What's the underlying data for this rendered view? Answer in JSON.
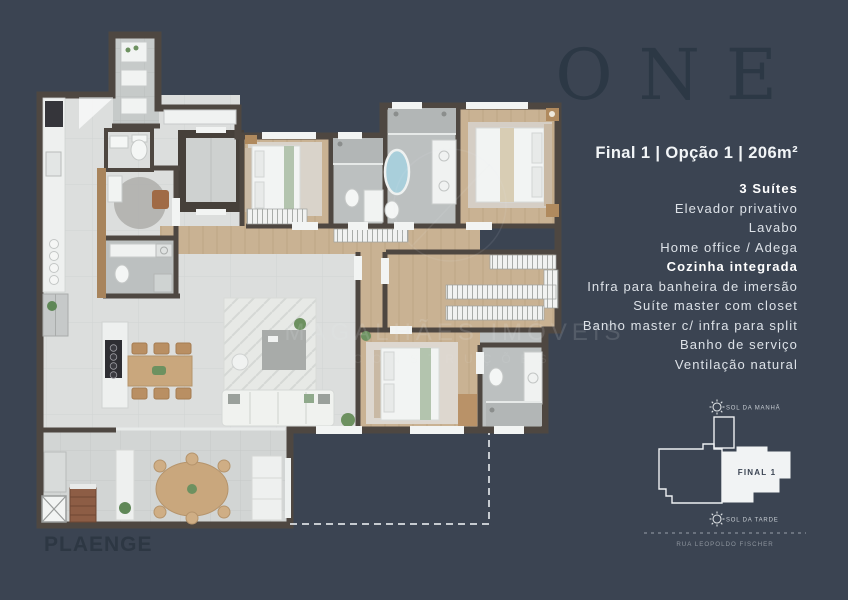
{
  "brand": {
    "development_logo": "ONE",
    "builder_logo": "PLAENGE"
  },
  "panel": {
    "title": "Final 1 | Opção 1 | 206m²",
    "features": [
      {
        "label": "3 Suítes",
        "bold": true
      },
      {
        "label": "Elevador privativo",
        "bold": false
      },
      {
        "label": "Lavabo",
        "bold": false
      },
      {
        "label": "Home office / Adega",
        "bold": false
      },
      {
        "label": "Cozinha integrada",
        "bold": true
      },
      {
        "label": "Infra para banheira de imersão",
        "bold": false
      },
      {
        "label": "Suíte master com closet",
        "bold": false
      },
      {
        "label": "Banho master c/ infra para split",
        "bold": false
      },
      {
        "label": "Banho de serviço",
        "bold": false
      },
      {
        "label": "Ventilação natural",
        "bold": false
      }
    ]
  },
  "keyplan": {
    "unit_label": "FINAL 1",
    "sun_morning": "SOL DA MANHÃ",
    "sun_afternoon": "SOL DA TARDE",
    "street": "RUA LEOPOLDO FISCHER"
  },
  "watermark": {
    "line1": "MAGALHÃES IMÓVEIS",
    "line2": "CONSTRUÇÕES"
  },
  "colors": {
    "background": "#3b4452",
    "wall": "#4e4741",
    "wood_floor": "#c9b293",
    "tile_floor": "#bcc0c0",
    "light_floor": "#dcdedd",
    "tub_blue": "#a9cfdb",
    "text": "#e8ecef"
  }
}
